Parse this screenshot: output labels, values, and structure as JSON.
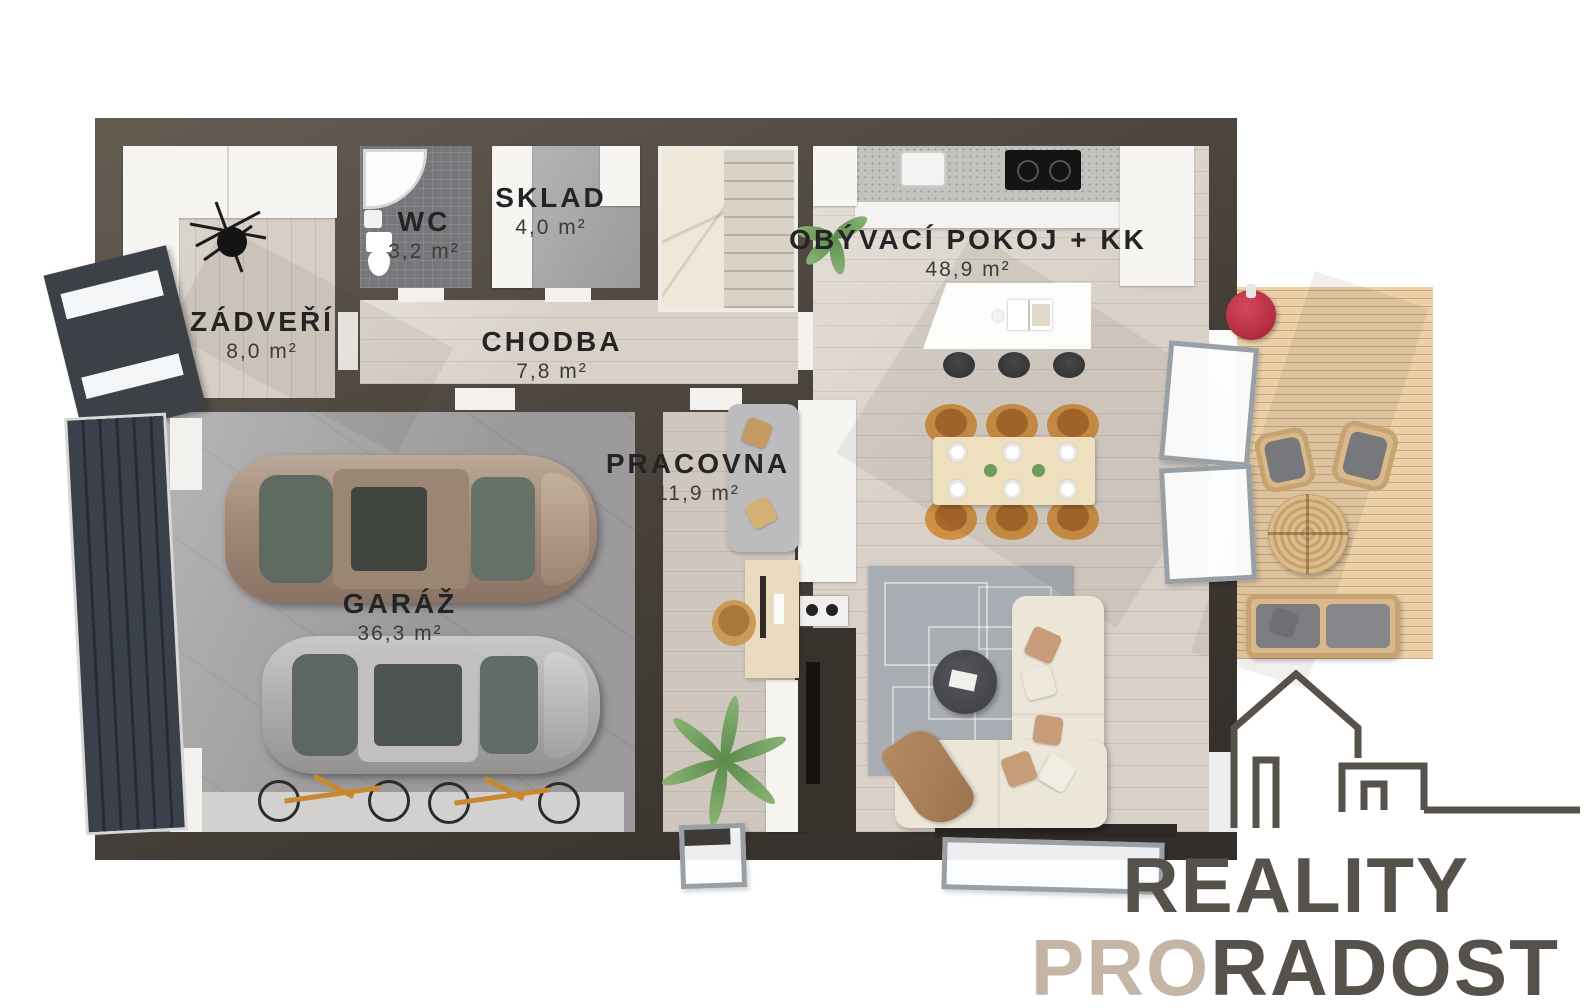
{
  "rooms": [
    {
      "id": "zadveri",
      "name": "ZÁDVEŘÍ",
      "area": "8,0 m²"
    },
    {
      "id": "wc",
      "name": "WC",
      "area": "3,2 m²"
    },
    {
      "id": "sklad",
      "name": "SKLAD",
      "area": "4,0 m²"
    },
    {
      "id": "chodba",
      "name": "CHODBA",
      "area": "7,8 m²"
    },
    {
      "id": "obyvaci",
      "name": "OBÝVACÍ POKOJ + KK",
      "area": "48,9 m²"
    },
    {
      "id": "pracovna",
      "name": "PRACOVNA",
      "area": "11,9 m²"
    },
    {
      "id": "garaz",
      "name": "GARÁŽ",
      "area": "36,3 m²"
    }
  ],
  "brand": {
    "word1": "REALITY",
    "word2_accent": "PRO",
    "word2_rest": "RADOST"
  },
  "colors": {
    "wall": "#4b443d",
    "label_text": "#242424",
    "logo_dark": "#56514a",
    "logo_accent": "#c5b5a4",
    "deck": "#ebd0a8",
    "grill_red": "#b32638",
    "dining_chair": "#c9873f",
    "sofa_cream": "#ece6d9",
    "rug": "#a9aeb4",
    "floor_wood": "#d9d1c8",
    "garage_floor": "#9c9a9b"
  }
}
